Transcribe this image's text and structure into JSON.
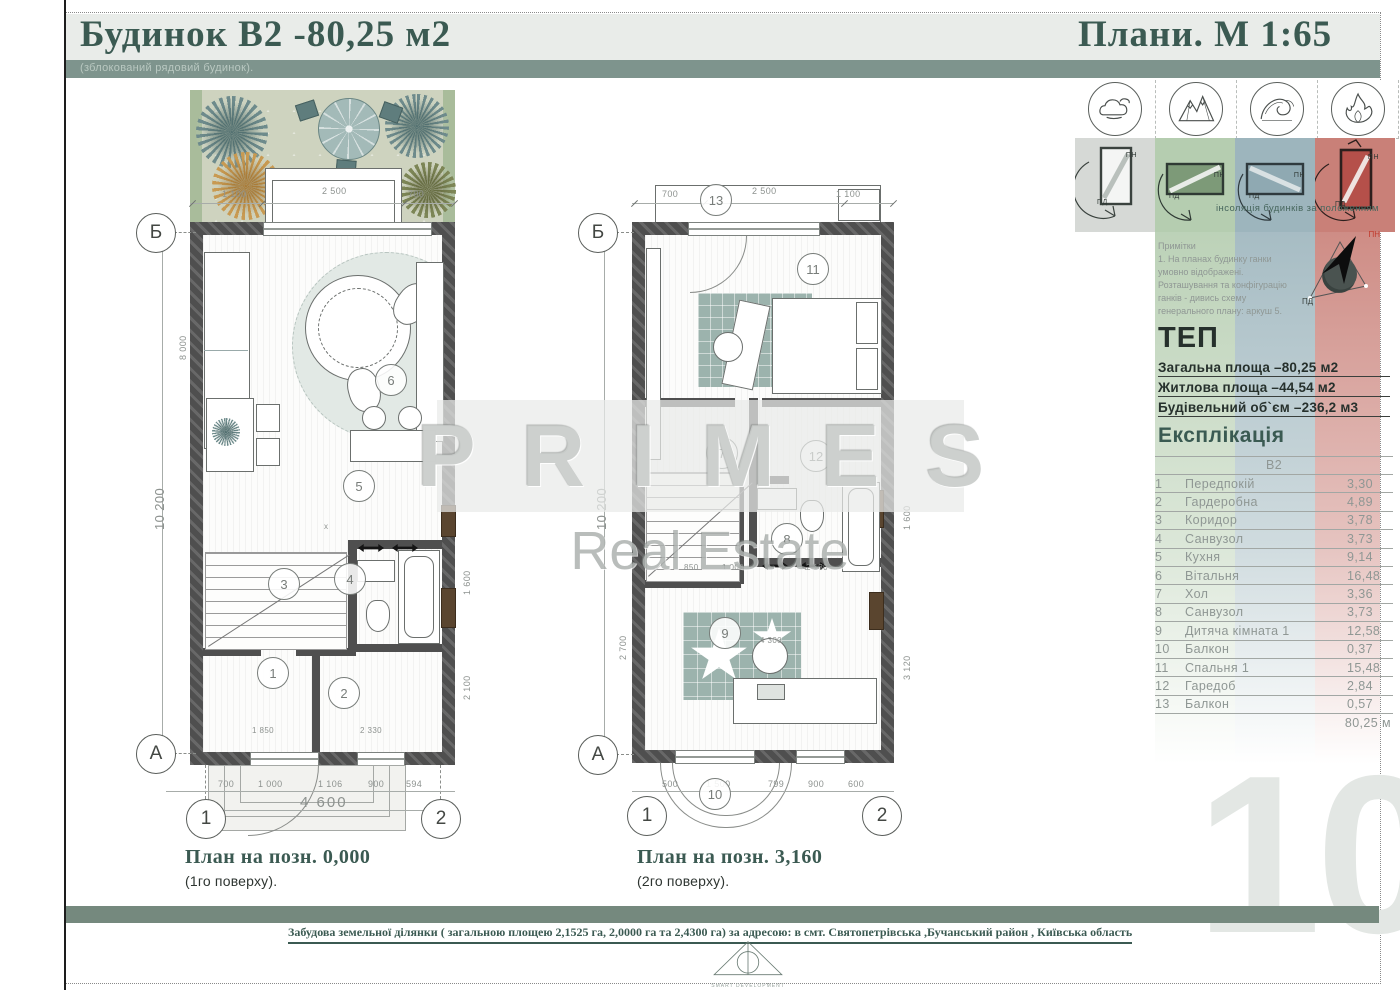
{
  "header": {
    "title": "Будинок В2 -80,25 м2",
    "subtitle": "(зблокований рядовий будинок).",
    "scale_title": "Плани. М 1:65"
  },
  "watermark": {
    "brand": "PRIMES",
    "sub": "Real Estate"
  },
  "plans": [
    {
      "caption": "План на позн. 0,000",
      "caption_sub": "(1го поверху).",
      "axis": {
        "top_row": "Б",
        "bottom_row": "А",
        "col_left": "1",
        "col_right": "2"
      },
      "rooms": [
        "6",
        "5",
        "3",
        "4",
        "1",
        "2"
      ],
      "closet_marker": "x",
      "dims": {
        "top": [
          "1 100",
          "2 500",
          "700"
        ],
        "left_total": "10 200",
        "left_inner": "8 000",
        "bottom": [
          "700",
          "1 000",
          "1 106",
          "900",
          "594"
        ],
        "bottom_total": "4 600",
        "right": [
          "1 600",
          "2 100"
        ],
        "inner": [
          "1 850",
          "2 330"
        ]
      }
    },
    {
      "caption": "План на позн. 3,160",
      "caption_sub": "(2го поверху).",
      "axis": {
        "top_row": "Б",
        "bottom_row": "А",
        "col_left": "1",
        "col_right": "2"
      },
      "rooms": [
        "13",
        "11",
        "7",
        "12",
        "8",
        "9",
        "10"
      ],
      "dims": {
        "top": [
          "700",
          "2 500",
          "1 100"
        ],
        "left_total": "10 200",
        "left_inner": "2 700",
        "bottom": [
          "500",
          "1 500",
          "799",
          "900",
          "600"
        ],
        "right": [
          "1 600",
          "3 120"
        ],
        "inner": [
          "850",
          "1 000",
          "2 130",
          "4 300"
        ]
      }
    }
  ],
  "sidebar": {
    "nature_icons": [
      "cloud-icon",
      "mountains-icon",
      "wave-icon",
      "flame-icon"
    ],
    "compass_labels": {
      "north": "ПН",
      "south": "ПД"
    },
    "insolation_caption": "інсоляція будинків за положенням",
    "notes": "Примітки\n1. На планах будинку ганки\nумовно відображені.\nРозташування та конфігурацію\nганків - дивись схему\nгенерального плану: аркуш 5.",
    "tep": {
      "heading": "ТЕП",
      "lines": [
        "Загальна площа –80,25 м2",
        "Житлова площа –44,54 м2",
        "Будівельний об`єм  –236,2 м3"
      ]
    },
    "explication": {
      "heading": "Експлікація",
      "column_header": "В2",
      "rows": [
        {
          "num": "1",
          "name": "Передпокій",
          "area": "3,30"
        },
        {
          "num": "2",
          "name": "Гардеробна",
          "area": "4,89"
        },
        {
          "num": "3",
          "name": "Коридор",
          "area": "3,78"
        },
        {
          "num": "4",
          "name": "Санвузол",
          "area": "3,73"
        },
        {
          "num": "5",
          "name": "Кухня",
          "area": "9,14"
        },
        {
          "num": "6",
          "name": "Вітальня",
          "area": "16,48"
        },
        {
          "num": "7",
          "name": "Хол",
          "area": "3,36"
        },
        {
          "num": "8",
          "name": "Санвузол",
          "area": "3,73"
        },
        {
          "num": "9",
          "name": "Дитяча кімната 1",
          "area": "12,58"
        },
        {
          "num": "10",
          "name": "Балкон",
          "area": "0,37"
        },
        {
          "num": "11",
          "name": "Спальня 1",
          "area": "15,48"
        },
        {
          "num": "12",
          "name": "Гаредоб",
          "area": "2,84"
        },
        {
          "num": "13",
          "name": "Балкон",
          "area": "0,57"
        }
      ],
      "total": "80,25 м"
    }
  },
  "footer": {
    "address_line": "Забудова земельної ділянки ( загальною площею 2,1525 га, 2,0000 га та 2,4300 га) за адресою: в смт. Святопетрівська ,Бучанський район , Київська область",
    "logo_text": "SMART DEVELOPMENT",
    "page_number": "10"
  },
  "colors": {
    "accent_teal": "#75897e",
    "header_text": "#3b5a52",
    "tile_gray": "#d6d9d6",
    "tile_green": "#b5cdb0",
    "tile_blue": "#9db5bd",
    "tile_red": "#c98078",
    "wall": "#4f4f4f",
    "rug_teal": "#9cb3ad"
  }
}
